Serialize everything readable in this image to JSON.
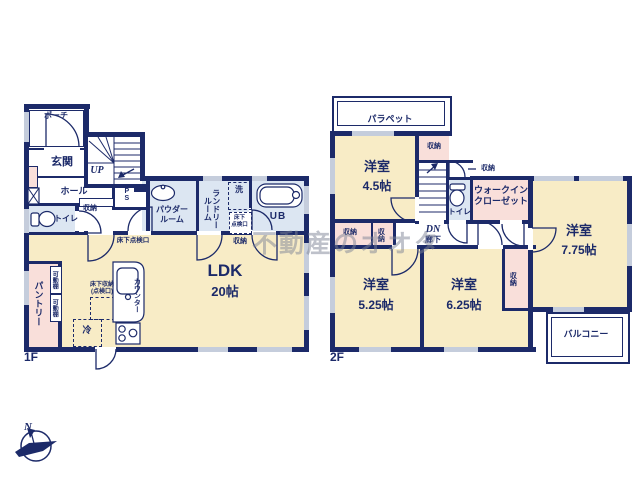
{
  "watermark": {
    "text": "不動産のオオタ"
  },
  "compass": {
    "north": "N"
  },
  "f1": {
    "floor_label": "1F",
    "porch": "ポーチ",
    "entrance": "玄関",
    "up": "UP",
    "hall": "ホール",
    "hall_storage": "収納",
    "toilet": "トイレ",
    "pipe_space": "PS",
    "powder_room": "パウダー\nルーム",
    "laundry_room": "ランドリー\nルーム",
    "washer": "洗",
    "laundry_underfloor": "床下\n点検口",
    "bath": "UB",
    "bath_storage": "収納",
    "hall_underfloor": "床下点検口",
    "ldk": "LDK",
    "ldk_size": "20帖",
    "pantry": "パントリー",
    "shelf_a": "可動棚",
    "shelf_b": "可動棚",
    "kitchen_underfloor": "床下収納\n(点検口)",
    "counter": "カウンター",
    "fridge": "冷"
  },
  "f2": {
    "floor_label": "2F",
    "parapet": "パラペット",
    "room45": "洋室",
    "room45_size": "4.5帖",
    "storage_top": "収納",
    "dn": "DN",
    "corridor": "廊下",
    "toilet": "トイレ",
    "toilet_storage": "収納",
    "wic": "ウォークイン\nクローゼット",
    "room775": "洋室",
    "room775_size": "7.75帖",
    "storage_mid_a": "収納",
    "storage_mid_b": "収納",
    "room525": "洋室",
    "room525_size": "5.25帖",
    "room625": "洋室",
    "room625_size": "6.25帖",
    "storage_right": "収納",
    "balcony": "バルコニー"
  }
}
